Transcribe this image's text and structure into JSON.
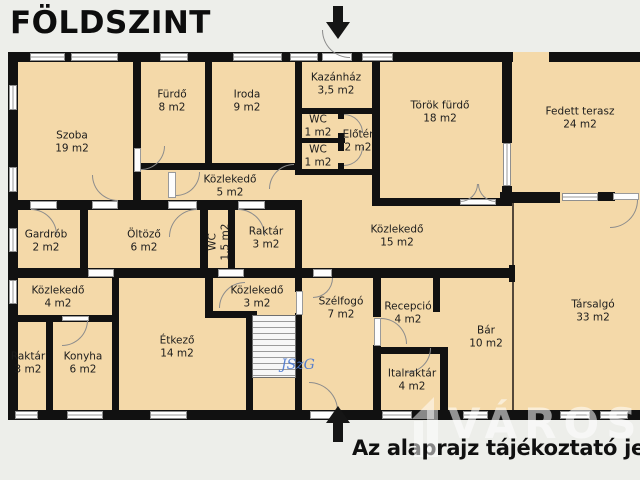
{
  "title": "FÖLDSZINT",
  "footer_note": "Az alaprajz tájékoztató jelle",
  "watermark": {
    "signature": "JSzG",
    "brand": "VÁROSI"
  },
  "colors": {
    "background": "#edeeea",
    "floor": "#f4d9a9",
    "wall": "#111111",
    "signature_blue": "#4a77cf",
    "text": "#1c1c1c"
  },
  "rooms": [
    {
      "name": "Szoba",
      "area": "19 m2"
    },
    {
      "name": "Fürdő",
      "area": "8 m2"
    },
    {
      "name": "Iroda",
      "area": "9 m2"
    },
    {
      "name": "Kazánház",
      "area": "3,5 m2"
    },
    {
      "name": "WC",
      "area": "1 m2"
    },
    {
      "name": "WC",
      "area": "1 m2"
    },
    {
      "name": "Előtér",
      "area": "2 m2"
    },
    {
      "name": "Török fürdő",
      "area": "18 m2"
    },
    {
      "name": "Fedett terasz",
      "area": "24 m2"
    },
    {
      "name": "Közlekedő",
      "area": "5 m2"
    },
    {
      "name": "Gardrób",
      "area": "2 m2"
    },
    {
      "name": "Öltöző",
      "area": "6 m2"
    },
    {
      "name": "WC",
      "area": "1,5 m2"
    },
    {
      "name": "Raktár",
      "area": "3 m2"
    },
    {
      "name": "Közlekedő",
      "area": "15 m2"
    },
    {
      "name": "Közlekedő",
      "area": "4 m2"
    },
    {
      "name": "Raktár",
      "area": "3 m2"
    },
    {
      "name": "Konyha",
      "area": "6 m2"
    },
    {
      "name": "Étkező",
      "area": "14 m2"
    },
    {
      "name": "Közlekedő",
      "area": "3 m2"
    },
    {
      "name": "Szélfogó",
      "area": "7 m2"
    },
    {
      "name": "Recepció",
      "area": "4 m2"
    },
    {
      "name": "Bár",
      "area": "10 m2"
    },
    {
      "name": "Italraktár",
      "area": "4 m2"
    },
    {
      "name": "Társalgó",
      "area": "33 m2"
    }
  ]
}
